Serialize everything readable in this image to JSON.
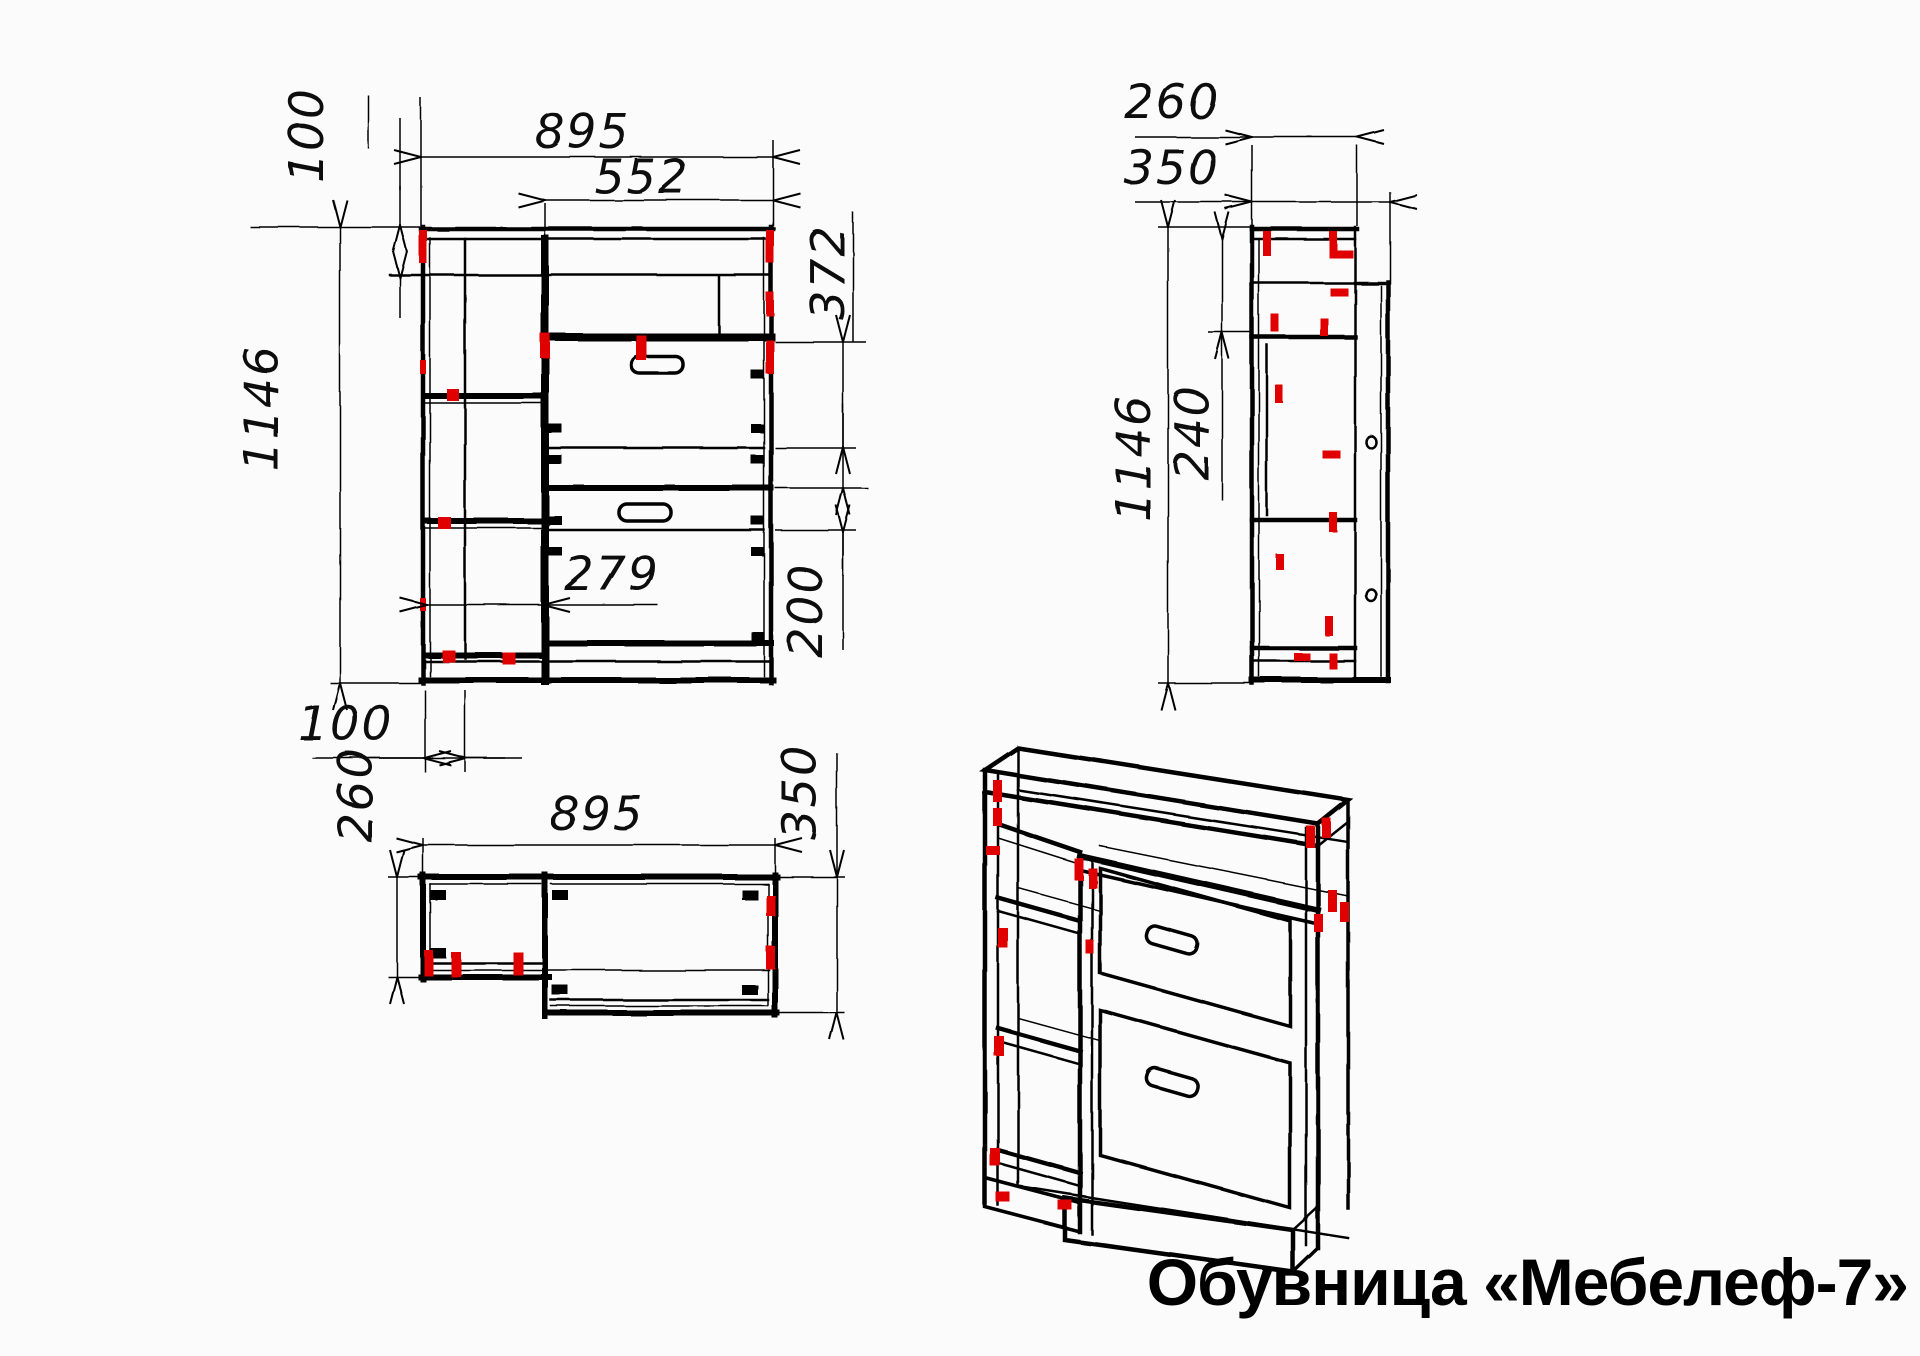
{
  "title": "Обувница «Мебелеф-7»",
  "colors": {
    "line": "#000000",
    "accent": "#e00000",
    "background": "#fbfbfb"
  },
  "views": {
    "front": {
      "dims": {
        "width": "895",
        "niche_width": "552",
        "top_height": "100",
        "height": "1146",
        "niche_height": "372",
        "bottom_gap": "200",
        "shelf_width": "279"
      }
    },
    "side": {
      "dims": {
        "top_depth": "260",
        "depth": "350",
        "height": "1146",
        "upper_section": "240"
      }
    },
    "plan": {
      "dims": {
        "side_offset": "100",
        "left_depth": "260",
        "width": "895",
        "right_depth": "350"
      }
    }
  }
}
